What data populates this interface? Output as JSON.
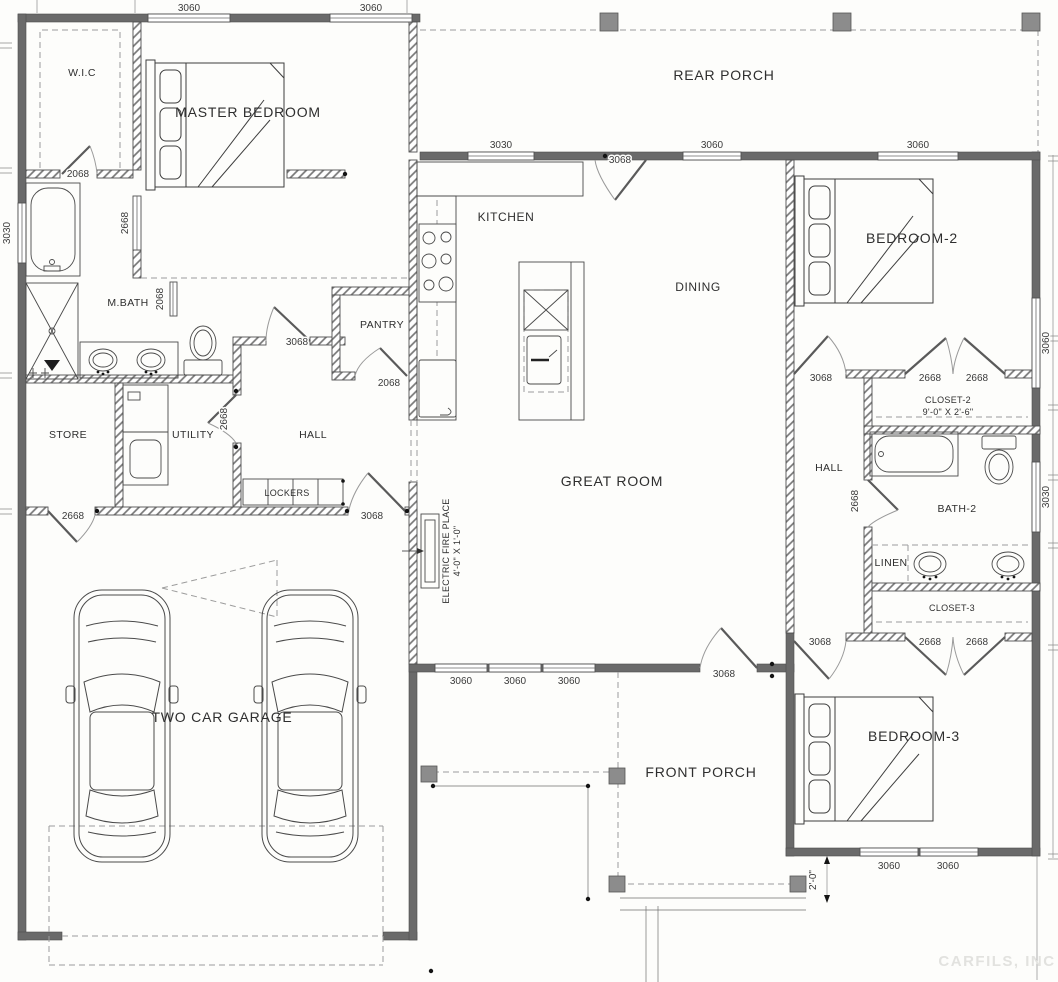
{
  "title": "Residential floor plan",
  "colors": {
    "wall": "#6a6a6a",
    "hatch_line": "#777777",
    "dashed": "#9c9c9c",
    "post": "#8c8c8c",
    "text": "#2e2e2e"
  },
  "labels": {
    "rear_porch": "REAR PORCH",
    "wic": "W.I.C",
    "master_bedroom": "MASTER BEDROOM",
    "kitchen": "KITCHEN",
    "dining": "DINING",
    "bedroom2": "BEDROOM-2",
    "mbath": "M.BATH",
    "pantry": "PANTRY",
    "store": "STORE",
    "utility": "UTILITY",
    "hall_left": "HALL",
    "lockers": "LOCKERS",
    "great_room": "GREAT ROOM",
    "hall_right": "HALL",
    "closet2": "CLOSET-2",
    "closet2_size": "9'-0\" X 2'-6\"",
    "bath2": "BATH-2",
    "linen": "LINEN",
    "closet3": "CLOSET-3",
    "fireplace_line1": "ELECTRIC FIRE PLACE",
    "fireplace_line2": "4'-0\" X 1'-0\"",
    "garage": "TWO CAR GARAGE",
    "front_porch": "FRONT PORCH",
    "bedroom3": "BEDROOM-3",
    "watermark": "CARFILS, INC"
  },
  "dimensions": {
    "top_win1": "3060",
    "top_win2": "3060",
    "left_win": "3030",
    "wic_door": "2068",
    "master_opening": "2668",
    "mbath_pocket": "2068",
    "mbath_door": "3068",
    "kit_win": "3030",
    "rear_door": "3068",
    "din_win": "3060",
    "bed2_win_top": "3060",
    "bed2_win_right": "3060",
    "bath2_win_right": "3030",
    "utility_door": "2668",
    "pantry_door": "2068",
    "store_door": "2668",
    "hall_garage_door": "3068",
    "bed2_door": "3068",
    "closet2_door1": "2668",
    "closet2_door2": "2668",
    "bath2_door": "2668",
    "bed3_door": "3068",
    "closet3_door1": "2668",
    "closet3_door2": "2668",
    "great_win1": "3060",
    "great_win2": "3060",
    "great_win3": "3060",
    "front_door": "3068",
    "bed3_win1": "3060",
    "bed3_win2": "3060",
    "porch_depth": "2'-0\""
  }
}
